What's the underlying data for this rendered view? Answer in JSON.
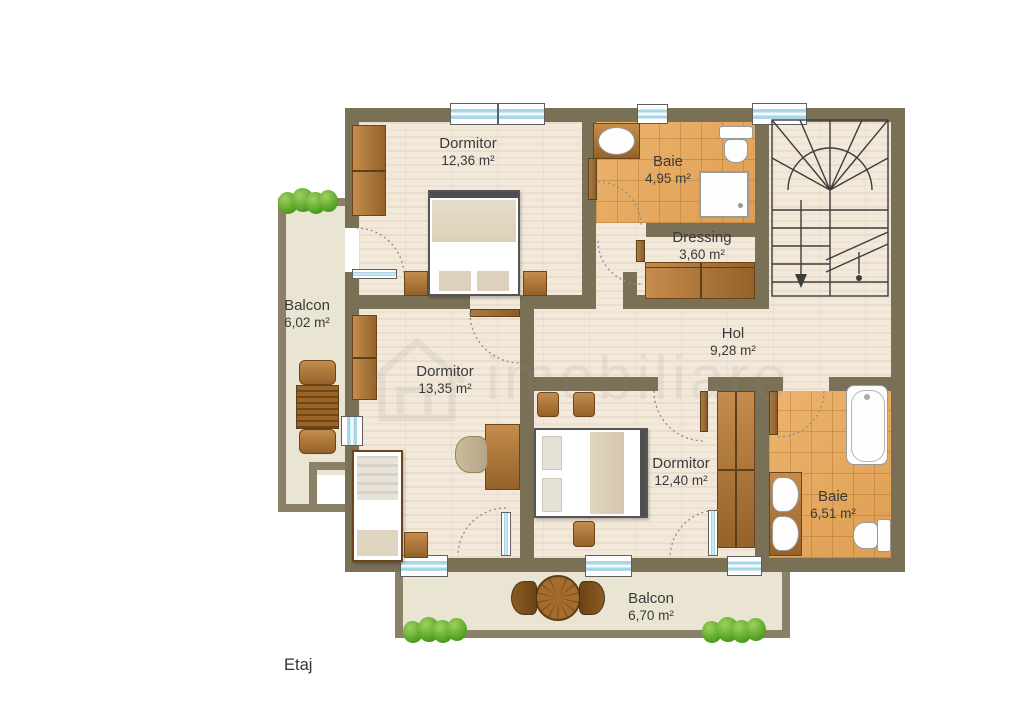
{
  "floor_label": "Etaj",
  "watermark": {
    "text": "imobiliare"
  },
  "rooms": [
    {
      "id": "bedroom-top",
      "name": "Dormitor",
      "area": "12,36 m²"
    },
    {
      "id": "bath-top",
      "name": "Baie",
      "area": "4,95 m²"
    },
    {
      "id": "dressing",
      "name": "Dressing",
      "area": "3,60 m²"
    },
    {
      "id": "hallway",
      "name": "Hol",
      "area": "9,28 m²"
    },
    {
      "id": "balcony-left",
      "name": "Balcon",
      "area": "6,02 m²"
    },
    {
      "id": "bedroom-left",
      "name": "Dormitor",
      "area": "13,35 m²"
    },
    {
      "id": "bedroom-mid",
      "name": "Dormitor",
      "area": "12,40 m²"
    },
    {
      "id": "bath-right",
      "name": "Baie",
      "area": "6,51 m²"
    },
    {
      "id": "balcony-bottom",
      "name": "Balcon",
      "area": "6,70 m²"
    }
  ],
  "colors": {
    "wall": "#7a7056",
    "balcony_wall": "#8a8168",
    "wood_floor": "#f2e9db",
    "tile_floor": "#e3a45f",
    "balcony_floor": "#eae5d3",
    "furniture_wood": "#a9732f",
    "window_glass": "#a9d6e6",
    "bush_green": "#54a426",
    "label_text": "#3a3a3a"
  }
}
